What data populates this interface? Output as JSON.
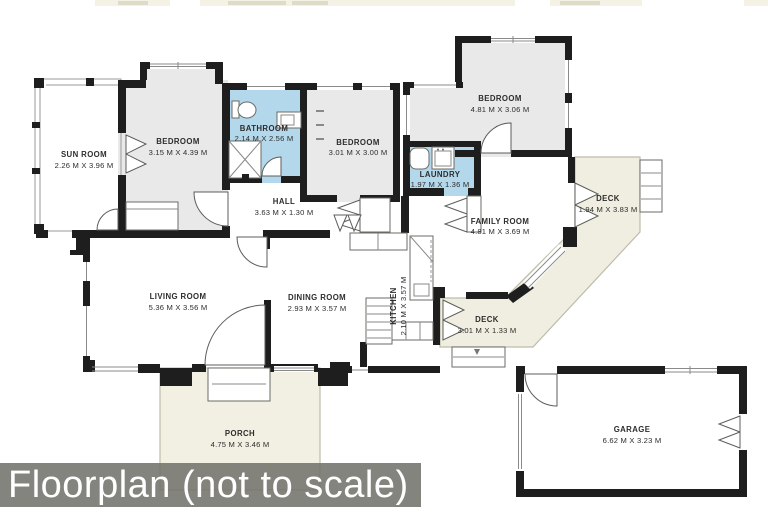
{
  "banner": {
    "label": "Floorplan (not to scale)"
  },
  "rooms": {
    "sun_room": {
      "name": "SUN ROOM",
      "dims": "2.26 M X 3.96 M"
    },
    "bedroom_1": {
      "name": "BEDROOM",
      "dims": "3.15 M X 4.39 M"
    },
    "bathroom": {
      "name": "BATHROOM",
      "dims": "2.14 M X 2.56 M"
    },
    "bedroom_2": {
      "name": "BEDROOM",
      "dims": "3.01 M X 3.00 M"
    },
    "hall": {
      "name": "HALL",
      "dims": "3.63 M X 1.30 M"
    },
    "bedroom_3": {
      "name": "BEDROOM",
      "dims": "4.81 M X 3.06 M"
    },
    "laundry": {
      "name": "LAUNDRY",
      "dims": "1.97 M X 1.36 M"
    },
    "family_room": {
      "name": "FAMILY ROOM",
      "dims": "4.81 M X 3.69 M"
    },
    "deck_upper": {
      "name": "DECK",
      "dims": "1.94 M X 3.83 M"
    },
    "living_room": {
      "name": "LIVING ROOM",
      "dims": "5.36 M X 3.56 M"
    },
    "dining_room": {
      "name": "DINING ROOM",
      "dims": "2.93 M X 3.57 M"
    },
    "kitchen": {
      "name": "KITCHEN",
      "dims": "2.10 M X 3.57 M"
    },
    "deck_lower": {
      "name": "DECK",
      "dims": "3.01 M X 1.33 M"
    },
    "porch": {
      "name": "PORCH",
      "dims": "4.75 M X 3.46 M"
    },
    "garage": {
      "name": "GARAGE",
      "dims": "6.62 M X 3.23 M"
    }
  },
  "colors": {
    "wall": "#1e1e1e",
    "room_fill": "#e9e9e9",
    "wet_room_fill": "#b4d8eb",
    "deck_fill": "#efeee0",
    "porch_fill": "#f1f0e2",
    "banner_bg": "#73736c",
    "banner_text": "#ffffff",
    "label_text": "#2d2d2d"
  }
}
